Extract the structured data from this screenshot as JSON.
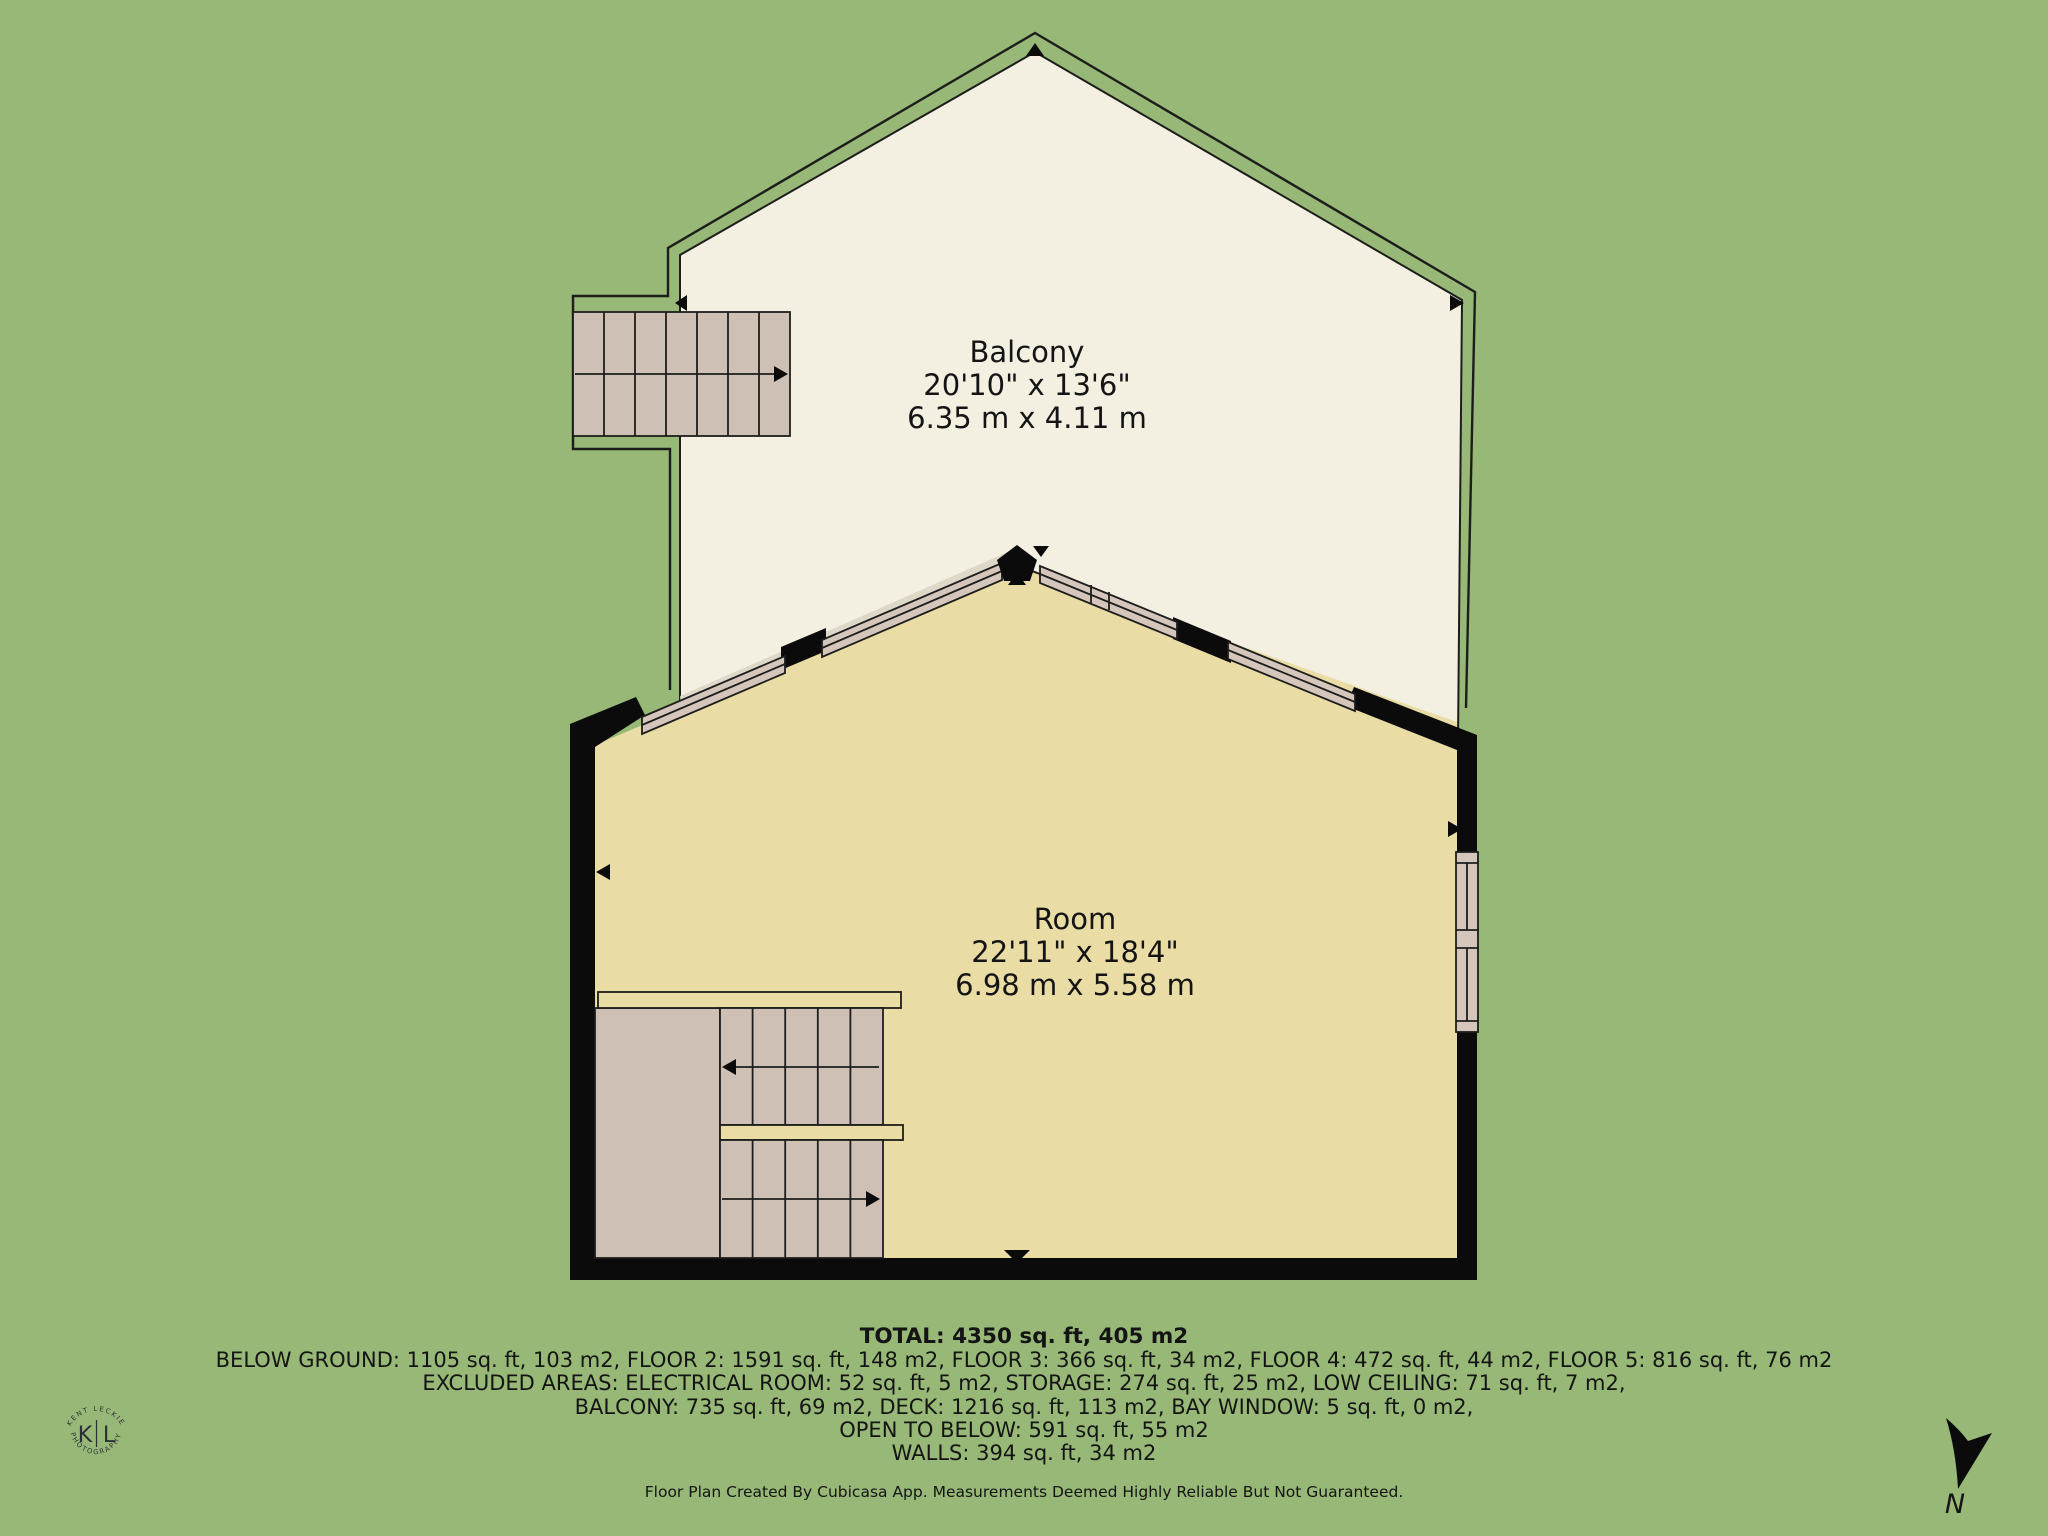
{
  "colors": {
    "background": "#97b876",
    "balcony": "#f3efe1",
    "room": "#eadca5",
    "stairs": "#cfc0b5",
    "window_frame": "#d5c6bc",
    "wall": "#0b0b0b",
    "line": "#1d1d1b",
    "shadow": "#d8d2c3",
    "ink": "#141414",
    "logo": "#2b2f36"
  },
  "balcony": {
    "name": "Balcony",
    "imperial": "20'10\" x 13'6\"",
    "metric": "6.35 m x 4.11 m"
  },
  "room": {
    "name": "Room",
    "imperial": "22'11\" x 18'4\"",
    "metric": "6.98 m x 5.58 m"
  },
  "summary": {
    "total": "TOTAL: 4350 sq. ft, 405 m2",
    "lines": [
      "BELOW GROUND: 1105 sq. ft, 103 m2, FLOOR 2: 1591 sq. ft, 148 m2, FLOOR 3: 366 sq. ft, 34 m2, FLOOR 4: 472 sq. ft, 44 m2, FLOOR 5: 816 sq. ft, 76 m2",
      "EXCLUDED AREAS: ELECTRICAL ROOM: 52 sq. ft, 5 m2, STORAGE: 274 sq. ft, 25 m2, LOW CEILING: 71 sq. ft, 7 m2,",
      "BALCONY: 735 sq. ft, 69 m2, DECK: 1216 sq. ft, 113 m2, BAY WINDOW: 5 sq. ft, 0 m2,",
      "OPEN TO BELOW: 591 sq. ft, 55 m2",
      "WALLS: 394 sq. ft, 34 m2"
    ],
    "footer": "Floor Plan Created By Cubicasa App. Measurements Deemed Highly Reliable But Not Guaranteed."
  },
  "logo": {
    "arc_top": "KENT LECKIE",
    "arc_bottom": "PHOTOGRAPHY",
    "initial_left": "K",
    "initial_right": "L"
  },
  "compass": {
    "label": "N"
  }
}
